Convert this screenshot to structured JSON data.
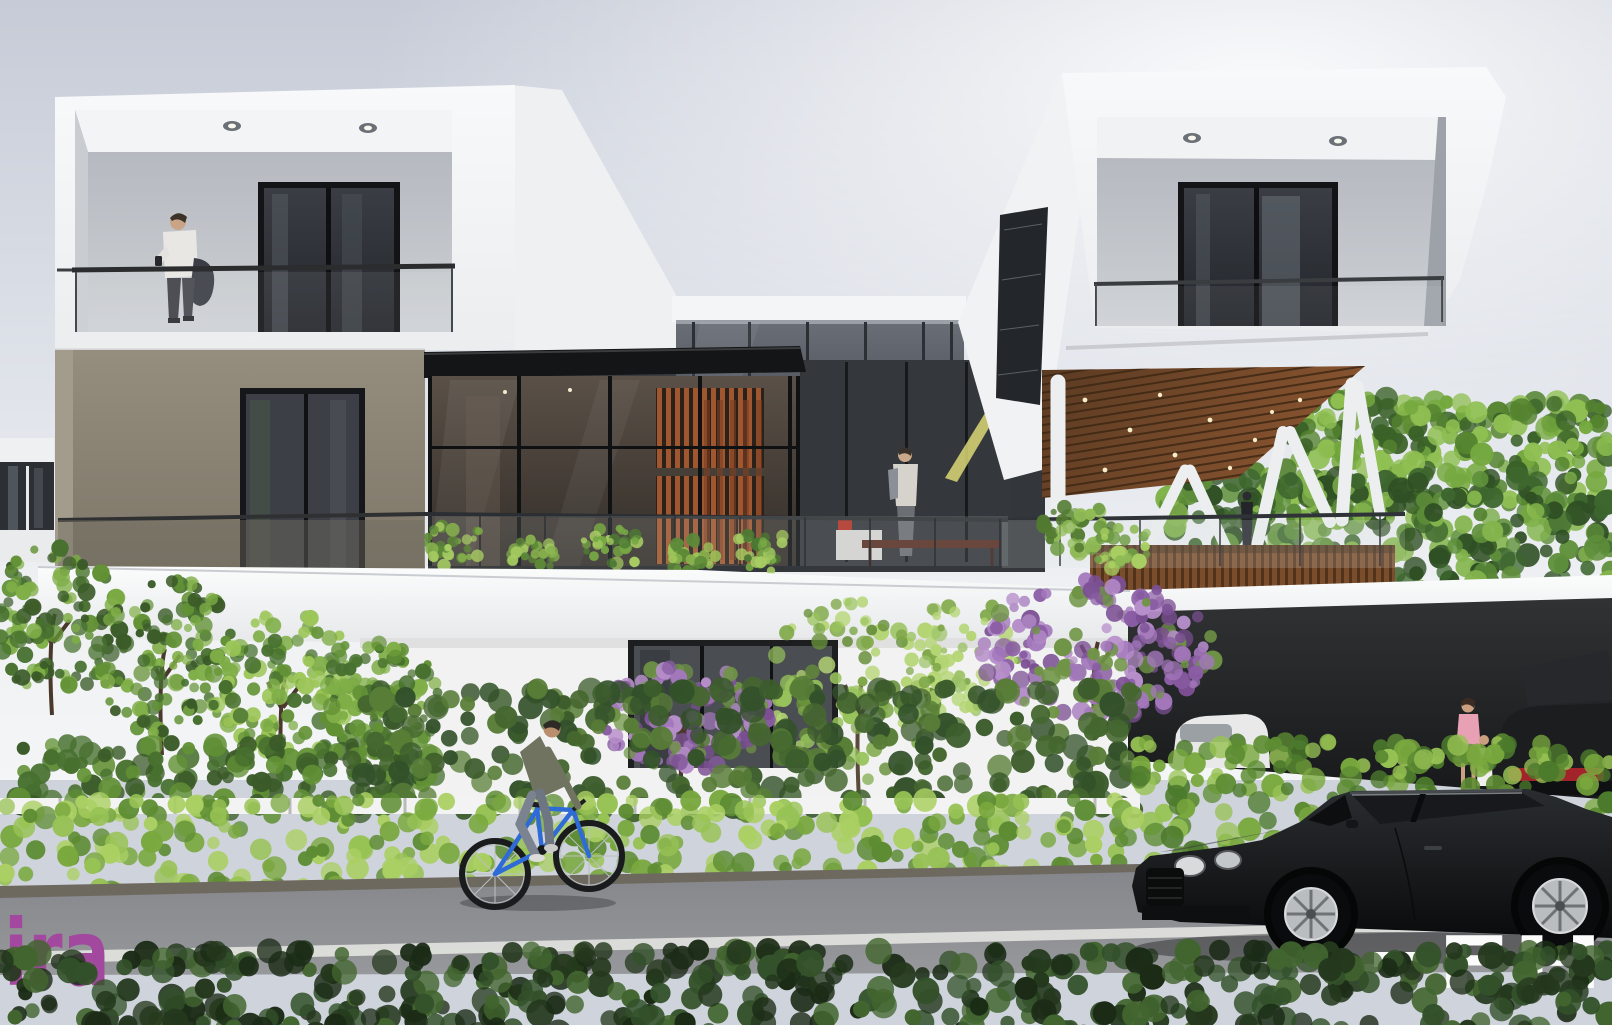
{
  "scene": {
    "kind": "architectural exterior 3D render",
    "description": "Modern white two-story villa with two cantilevered balcony volumes, central glass pavilion with timber slat screens, angled white columns under a wood soffit, street in foreground with hedges, a cyclist on a blue bicycle, and a black luxury coupe beside a carport with a parked car and a woman with a child"
  },
  "watermarks": {
    "left": "ira",
    "right": "FH"
  },
  "colors": {
    "sky_top": "#c6cbd7",
    "sky_light": "#f3f4f6",
    "white_wall": "#f5f6f7",
    "wall_shade": "#e8eaed",
    "taupe_wall": "#8b8476",
    "dark_glass": "#32363b",
    "clerestory": "#565b62",
    "wood_soffit": "#6e441f",
    "wood_slat": "#a0562f",
    "hedge_dark": "#2f4a24",
    "hedge_bright": "#7fae3f",
    "foliage_light": "#9cc658",
    "bloom_purple": "#a377bb",
    "road": "#8f9093",
    "curb": "#6e695f",
    "lane_line": "#e3e4e0",
    "car_black": "#141517",
    "watermark_purple": "#a2489e",
    "watermark_white": "#fbfbfb"
  }
}
